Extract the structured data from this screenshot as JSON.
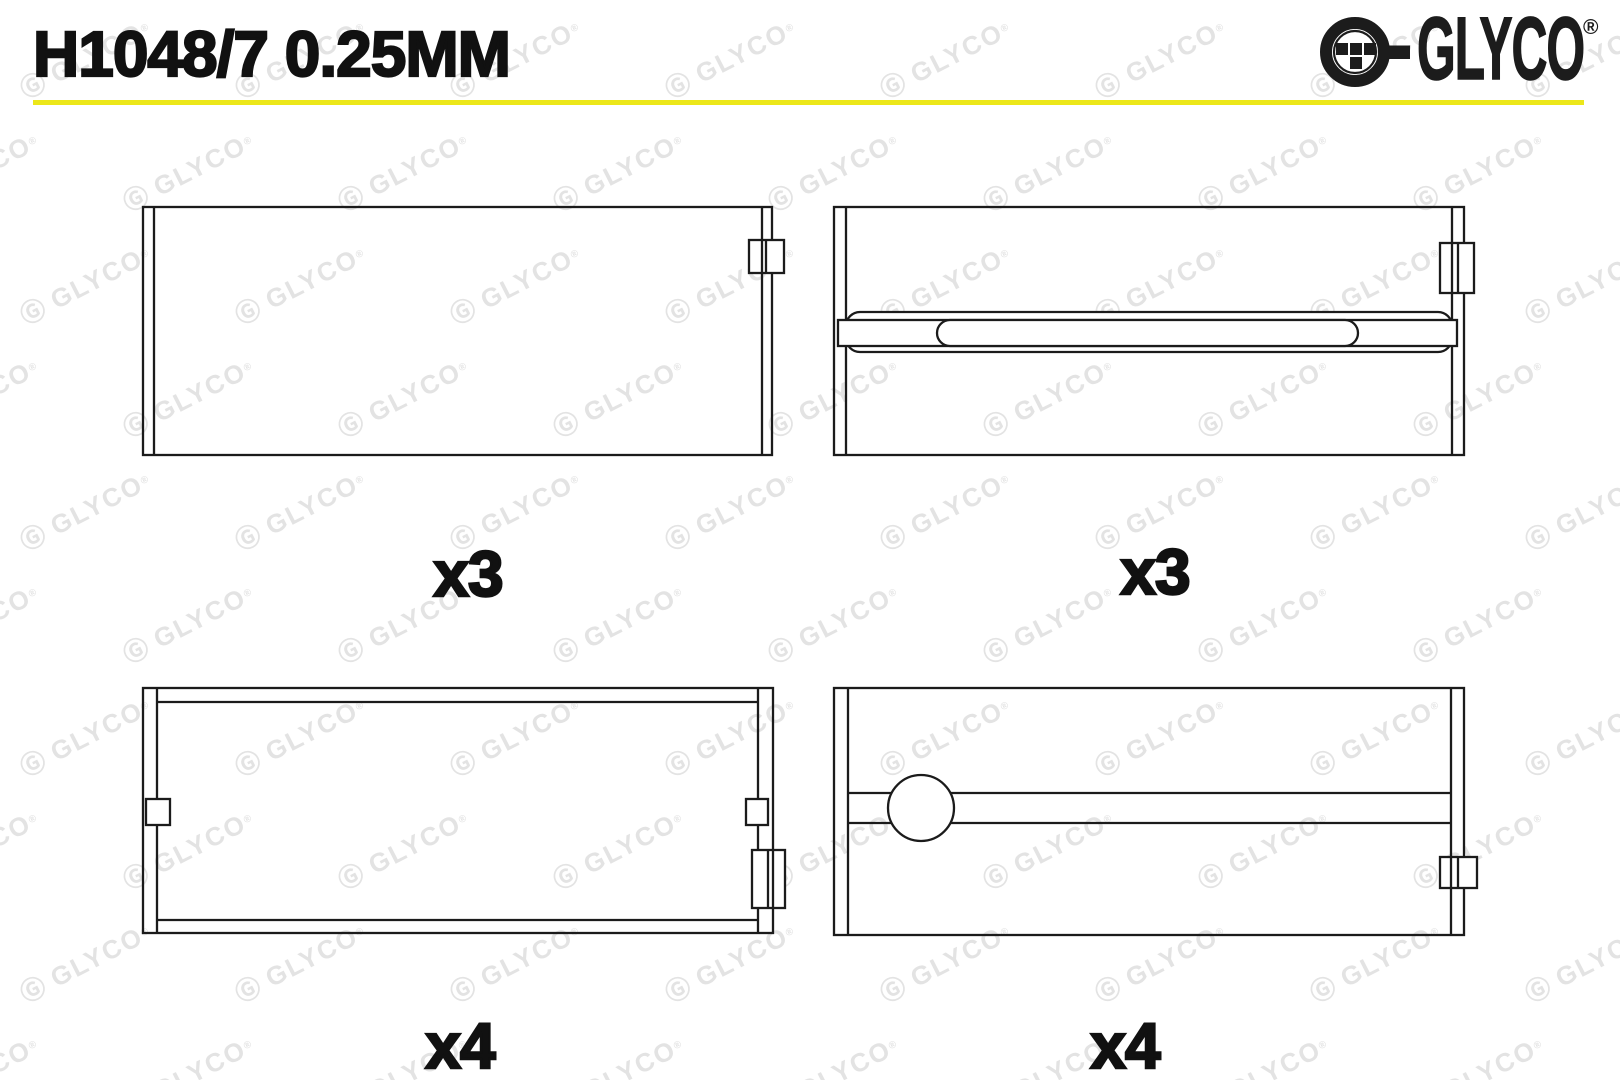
{
  "page": {
    "title_part_number": "H1048/7 0.25MM"
  },
  "brand": {
    "name": "GLYCO",
    "registered_mark": "®"
  },
  "watermark": {
    "glyph": "Ⓖ",
    "text": "GLYCO",
    "mark": "®"
  },
  "drawings": [
    {
      "position": "top-left",
      "quantity": "x3"
    },
    {
      "position": "top-right",
      "quantity": "x3"
    },
    {
      "position": "bottom-left",
      "quantity": "x4"
    },
    {
      "position": "bottom-right",
      "quantity": "x4"
    }
  ],
  "colors": {
    "accent_yellow": "#ece71a",
    "line": "#1b1b1b",
    "watermark": "#e3e3e3",
    "text": "#111111"
  }
}
